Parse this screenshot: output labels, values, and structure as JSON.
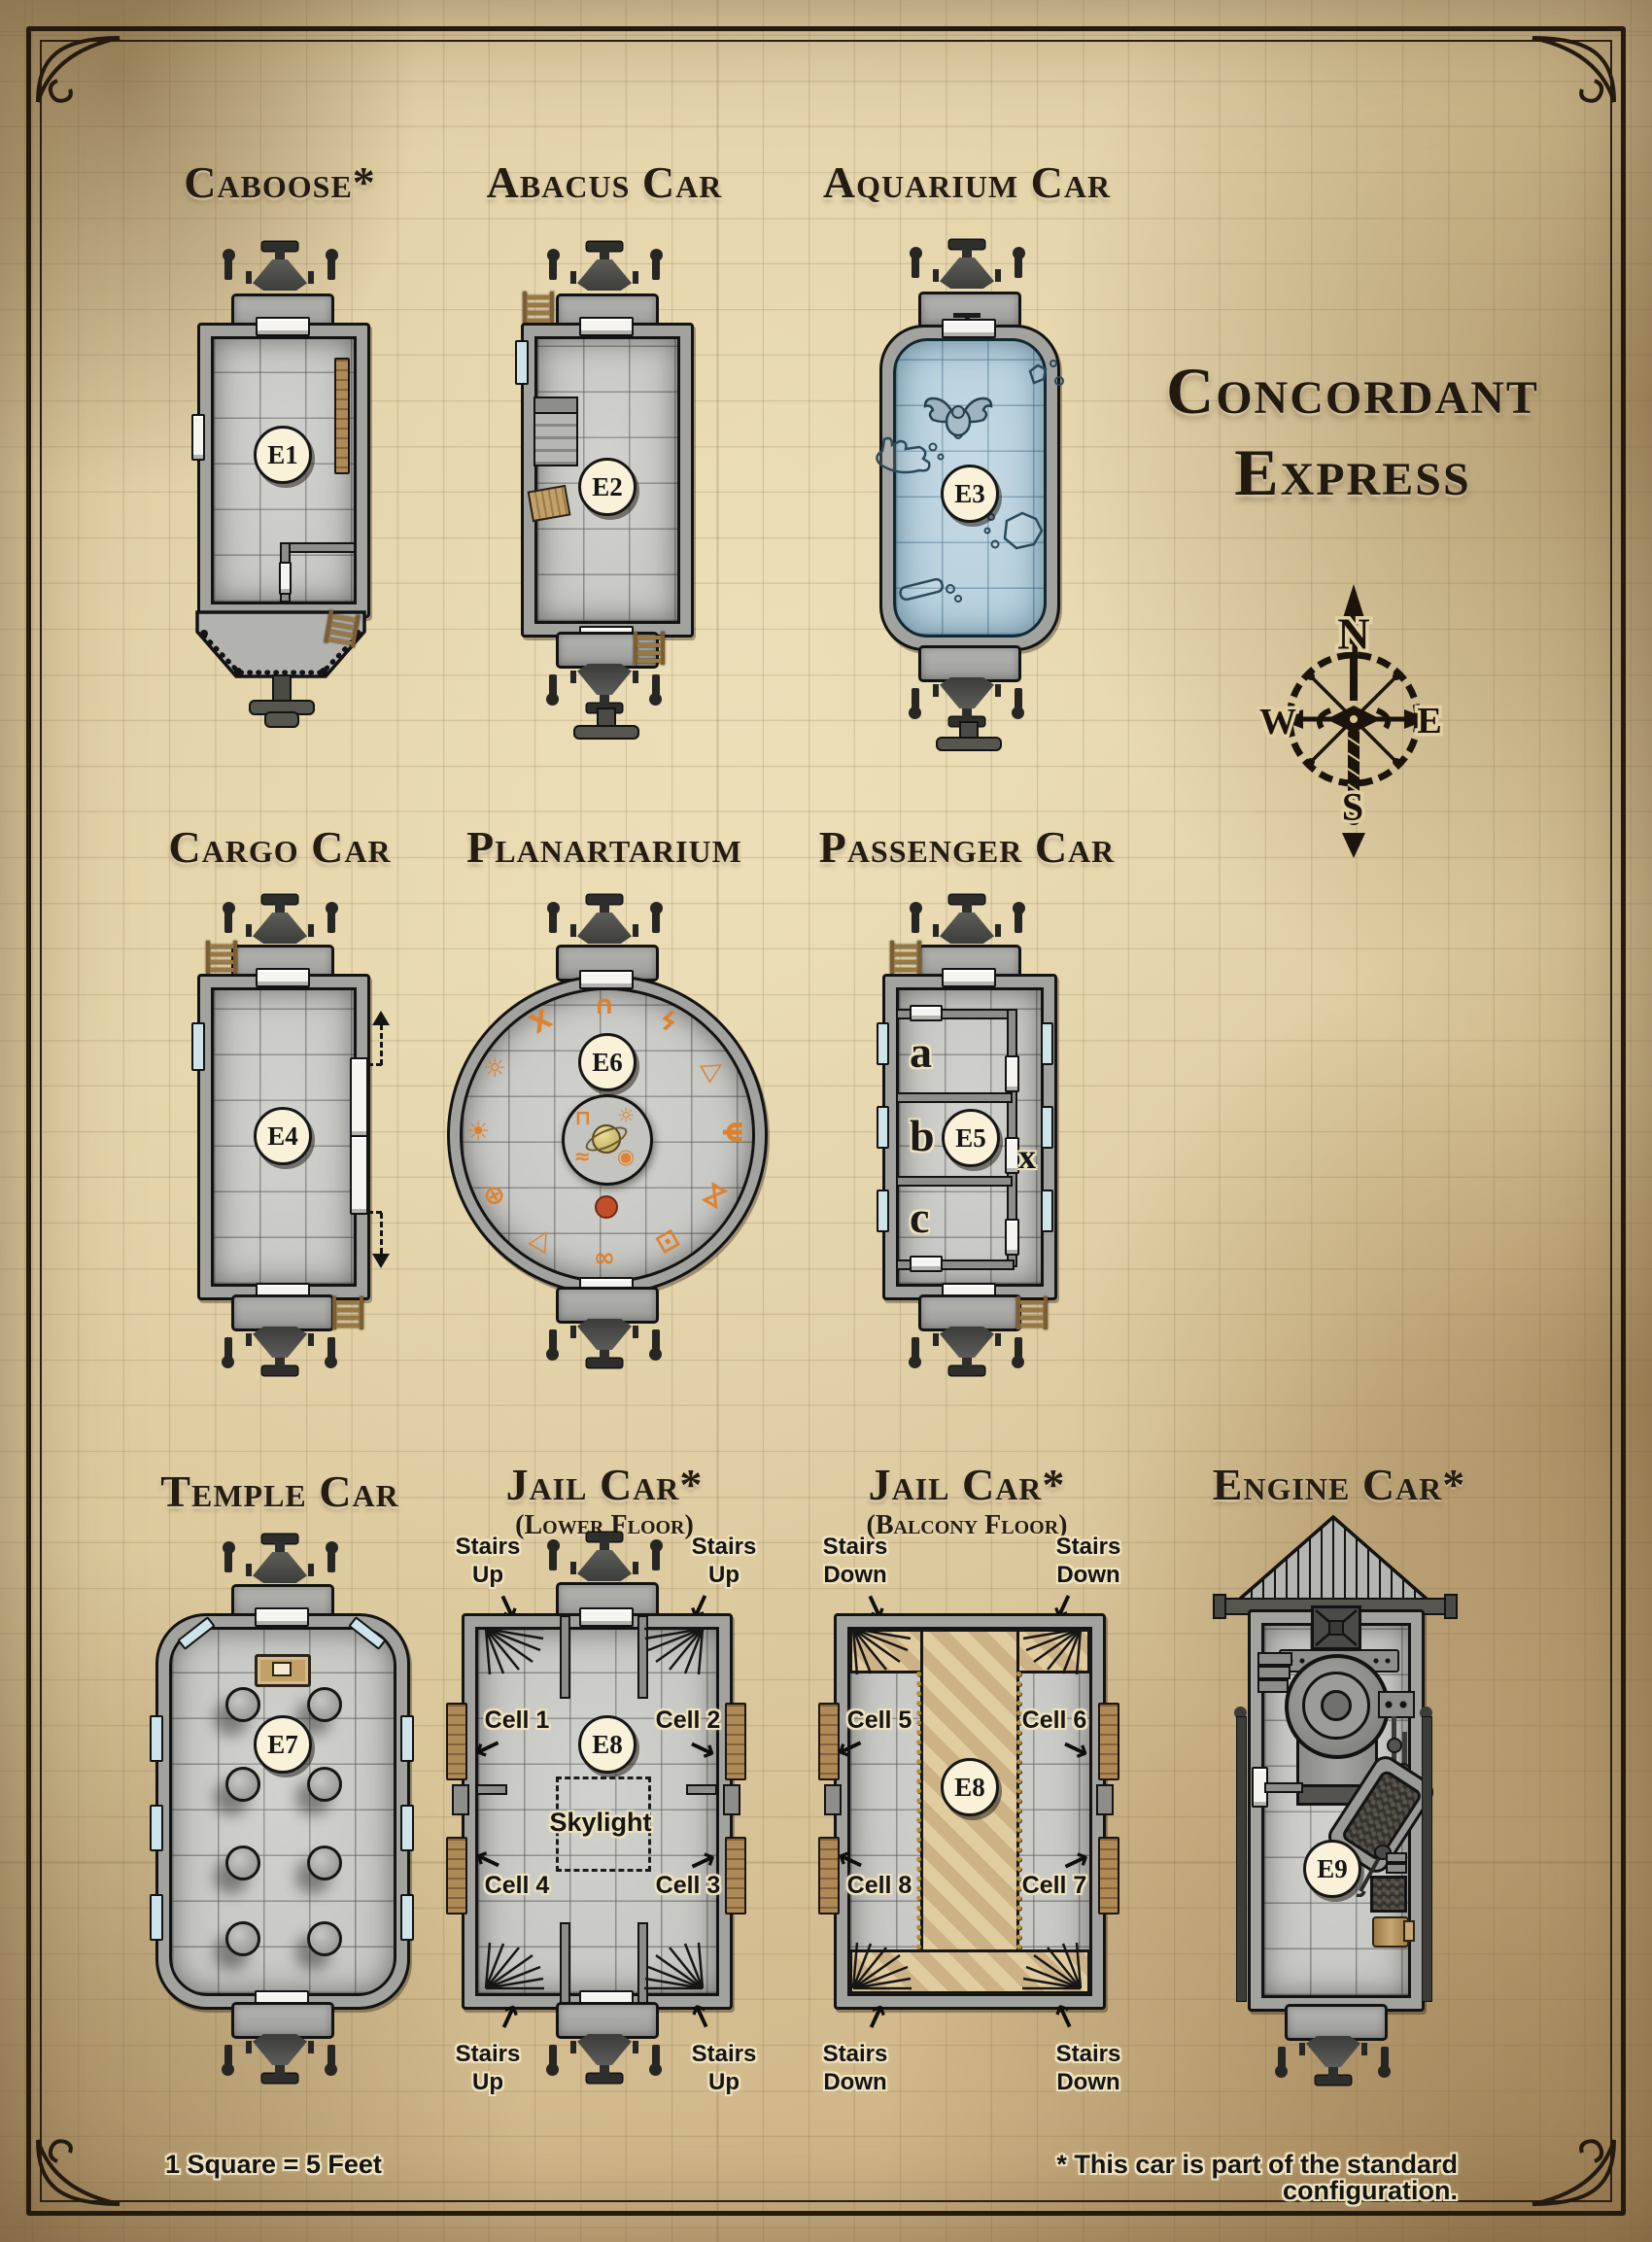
{
  "title": {
    "line1": "Concordant",
    "line2": "Express"
  },
  "compass": {
    "north": "N",
    "east": "E",
    "south": "S",
    "west": "W"
  },
  "legend": {
    "scale": "1 Square = 5 Feet",
    "footnote": "*  This car is part of the standard configuration."
  },
  "cars": {
    "caboose": {
      "title": "Caboose*",
      "label": "E1"
    },
    "abacus": {
      "title": "Abacus Car",
      "label": "E2"
    },
    "aquarium": {
      "title": "Aquarium Car",
      "label": "E3"
    },
    "cargo": {
      "title": "Cargo Car",
      "label": "E4"
    },
    "planartarium": {
      "title": "Planartarium",
      "label": "E6",
      "outer_symbols": [
        "∩",
        "ϟ",
        "△",
        "Ψ",
        "⋈",
        "⊡",
        "∞",
        "▽",
        "⊕",
        "☀",
        "☼",
        "Χ"
      ],
      "inner_symbols": [
        "⊓",
        "☼",
        "≈",
        "◉"
      ]
    },
    "passenger": {
      "title": "Passenger Car",
      "label": "E5",
      "rooms": [
        "a",
        "b",
        "c"
      ],
      "corridor": "x"
    },
    "temple": {
      "title": "Temple Car",
      "label": "E7"
    },
    "jail_lower": {
      "title": "Jail Car*",
      "subtitle": "(Lower Floor)",
      "label": "E8",
      "cells": [
        "Cell 1",
        "Cell 2",
        "Cell 3",
        "Cell 4"
      ],
      "skylight": "Skylight",
      "stair_note": "Stairs\nUp"
    },
    "jail_balcony": {
      "title": "Jail Car*",
      "subtitle": "(Balcony Floor)",
      "label": "E8",
      "cells": [
        "Cell 5",
        "Cell 6",
        "Cell 7",
        "Cell 8"
      ],
      "stair_note": "Stairs\nDown"
    },
    "engine": {
      "title": "Engine Car*",
      "label": "E9"
    }
  }
}
